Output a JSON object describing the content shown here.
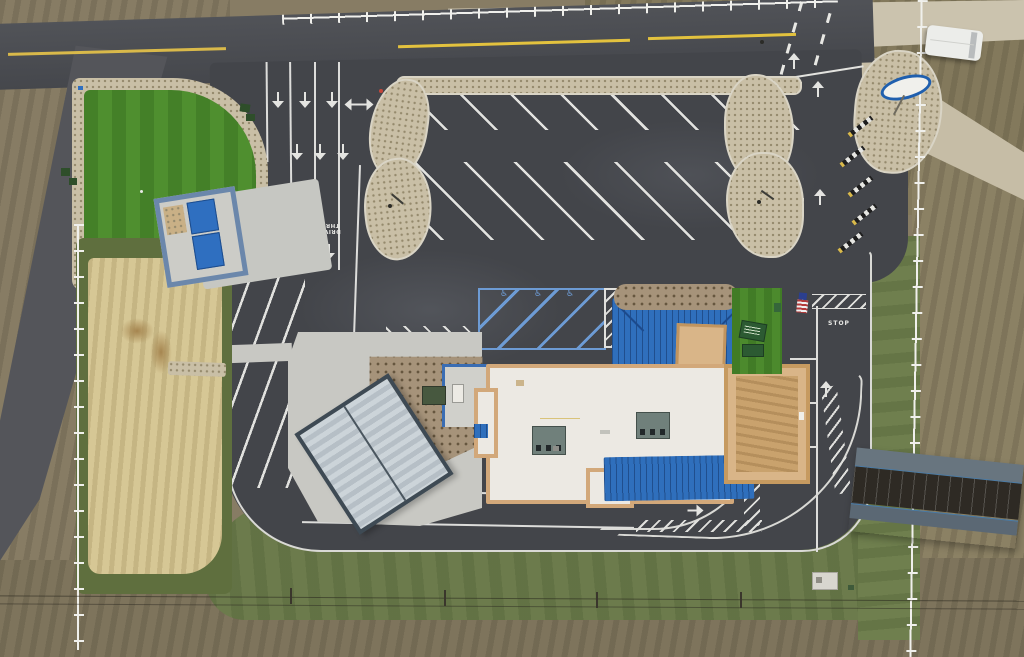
{
  "scene": {
    "title": "Aerial drone view — newly built drive-thru restaurant and parking lot",
    "view": "top-down"
  },
  "pavement": {
    "drive_thru_label_1": "DRIVE\nTHRU",
    "drive_thru_label_2": "DRIVE\nTHRU",
    "stop_label": "STOP",
    "queue_number_1": "1",
    "queue_number_2": "2",
    "accessible_symbol": "♿"
  },
  "colors": {
    "asphalt": "#43454a",
    "road": "#4a4c51",
    "roof_white": "#ece9e3",
    "roof_blue": "#2f6fbc",
    "parapet_tan": "#d2a87a",
    "canopy_tan": "#c9a26d",
    "handicap_blue": "#6d9bd4",
    "marking_white": "#e4e4e1",
    "lane_yellow": "#e3c23e",
    "turf_green": "#4f8f2f",
    "grass_green": "#6c7b4c",
    "straw_tan": "#d6c795",
    "gravel_tan": "#c9bfa6",
    "dumpster_blue": "#2f6fc0",
    "flag_red": "#b23a3a",
    "flag_blue": "#2b3f8e",
    "sign_blue": "#1f5fae"
  },
  "landmarks": [
    "putting-green",
    "dumpster-enclosure",
    "patio-canopy",
    "drive-thru-canopy",
    "hvac-units",
    "us-flag",
    "menu-boards",
    "white-van",
    "oval-business-sign",
    "rail-fence",
    "power-lines",
    "ramp-structure",
    "transformer",
    "straw-seeded-area"
  ]
}
